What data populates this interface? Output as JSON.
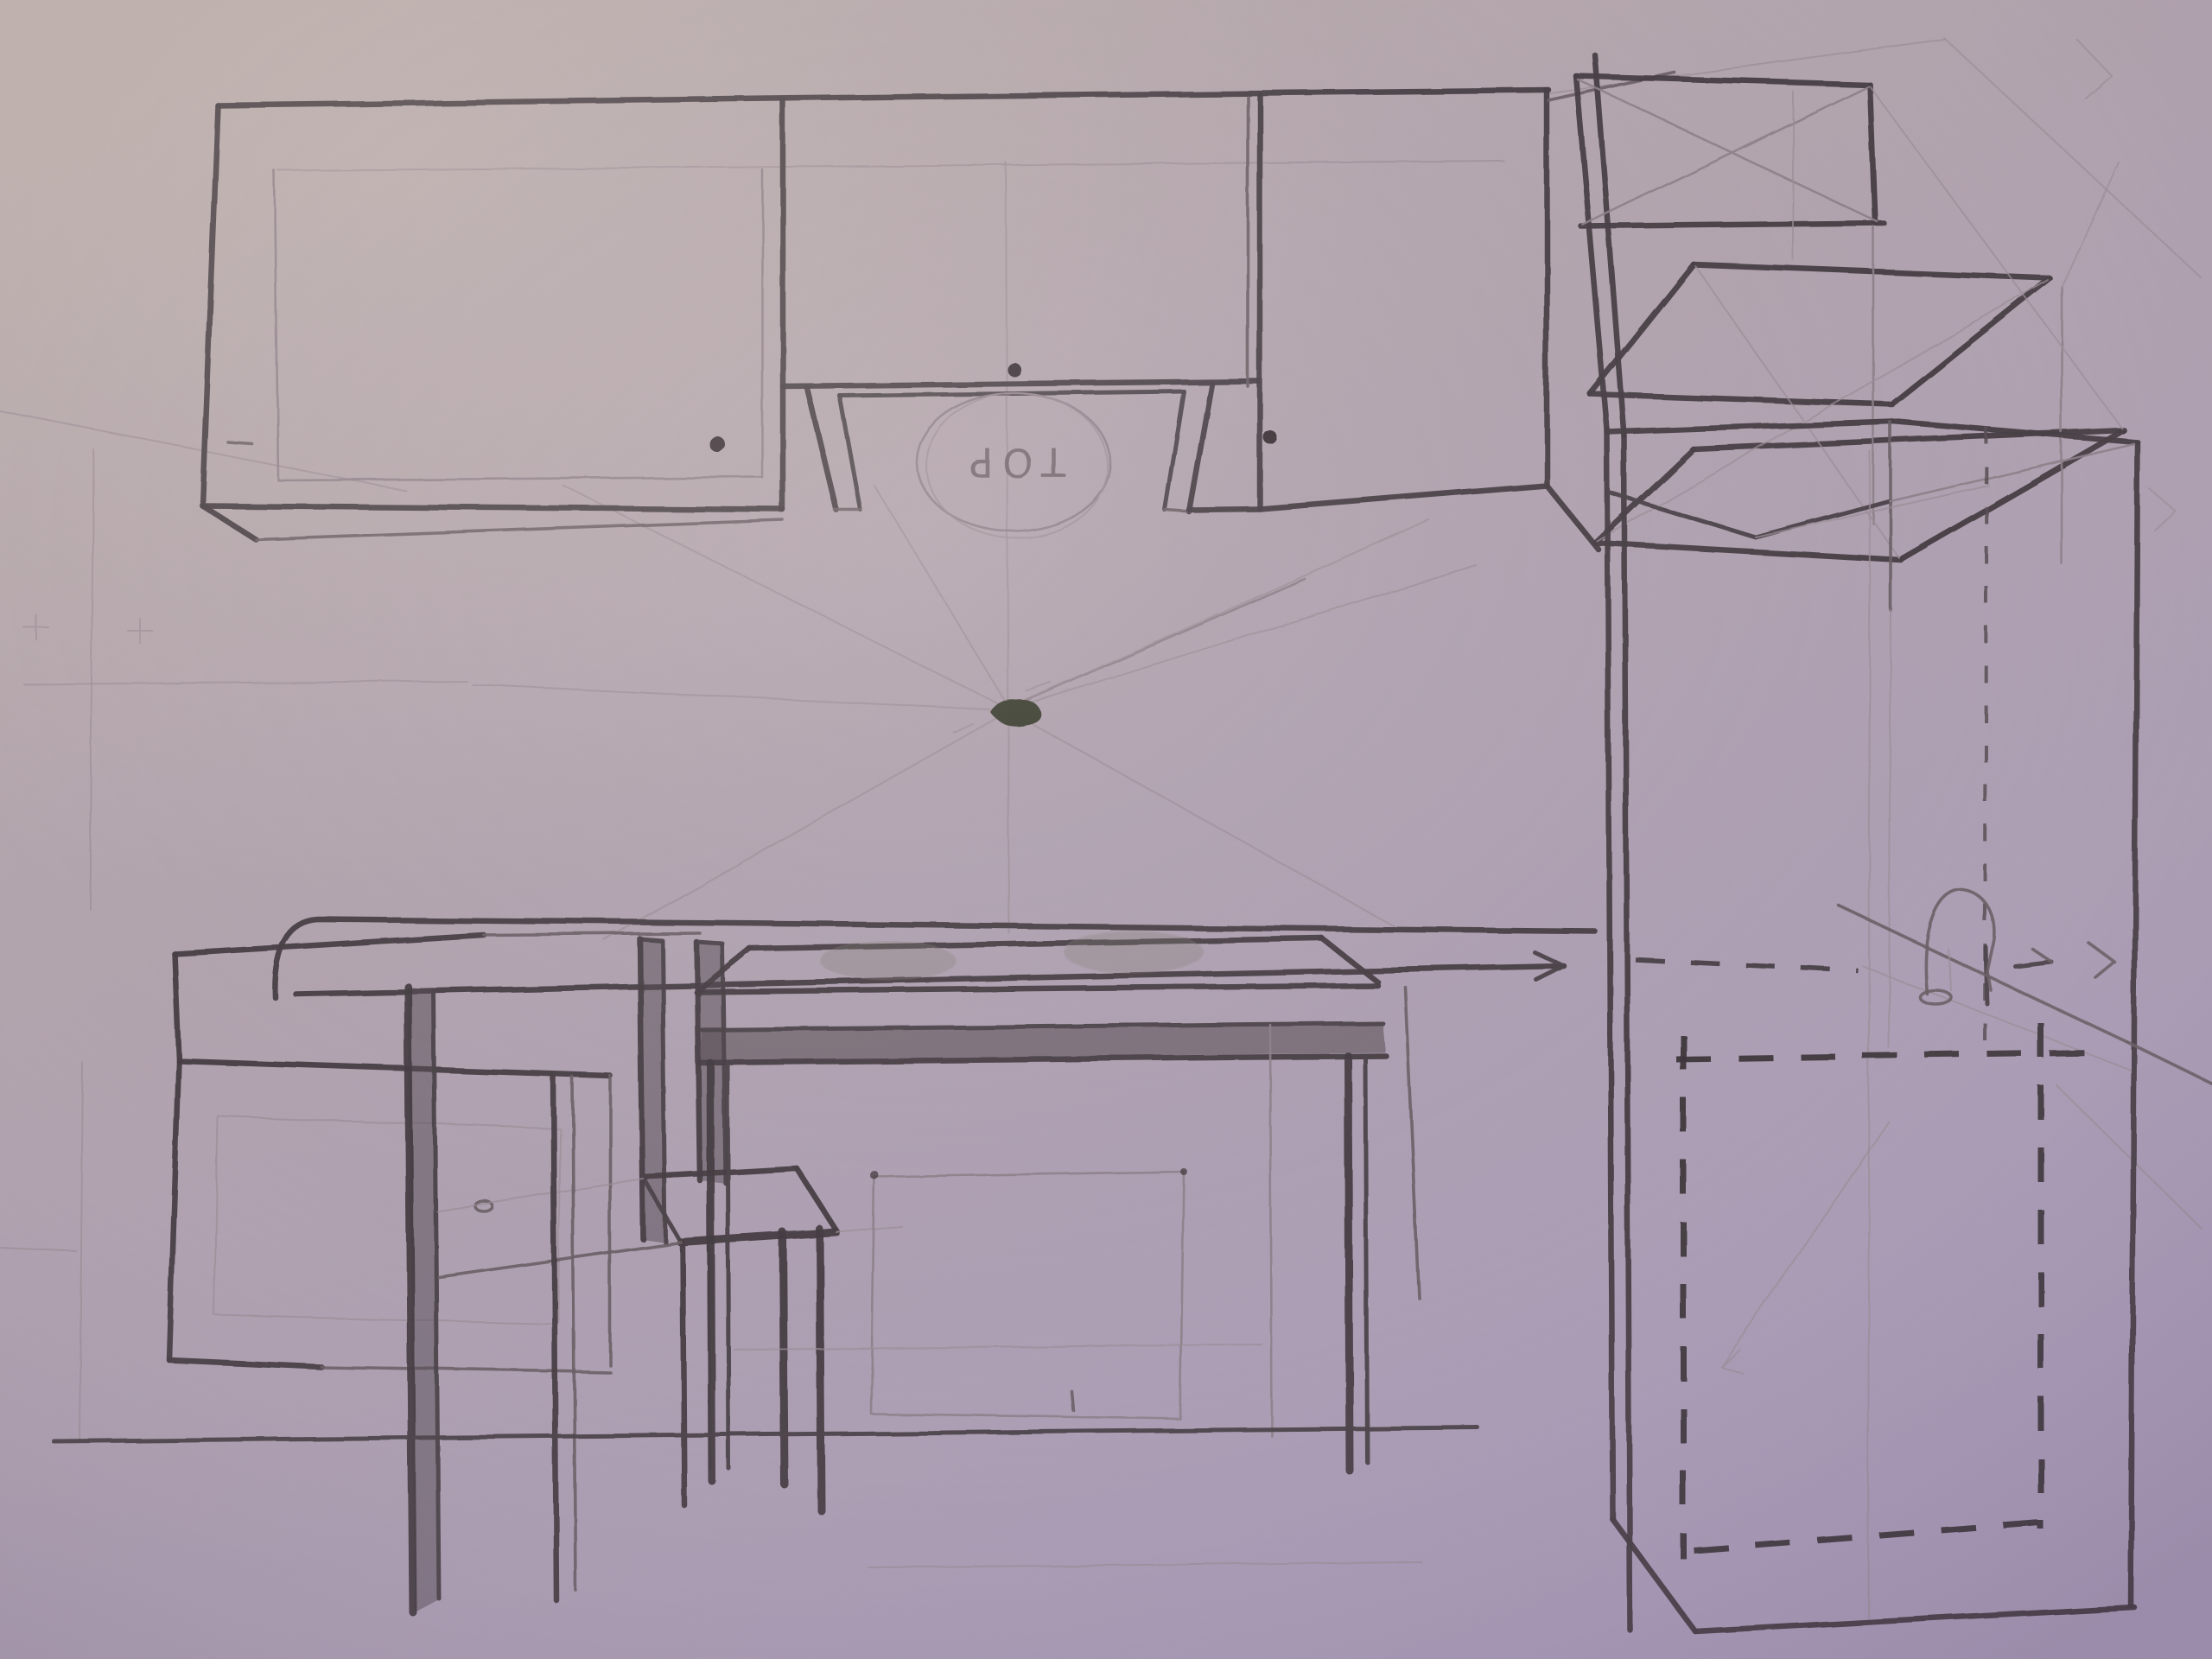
{
  "sketch": {
    "subject": "One-point perspective pencil sketch of a kitchen",
    "medium": "graphite on paper, photographed with a purple cast",
    "hood_label": "TOP",
    "hood_label_note": "written upside-down inside a circle in the niche under the middle wall cabinet",
    "palette": {
      "paper_top_left": "#b9aca8",
      "paper_mid": "#b2a4ae",
      "paper_bottom": "#ab9db8",
      "graphite_dark": "#453d42",
      "graphite_mid": "#6a5e64",
      "graphite_light": "#9b8d95",
      "vp_blot": "#3e4031"
    },
    "elements": [
      {
        "name": "upper-cabinet-row",
        "detail": "three wall cabinets with round door knobs"
      },
      {
        "name": "hood-recess",
        "detail": "open niche below middle cabinet with circled TOP mark"
      },
      {
        "name": "wall-shelf-unit",
        "detail": "open frame with two slanted shelves, top right"
      },
      {
        "name": "tall-cabinet",
        "detail": "full-height unit with dashed hidden-appliance outline"
      },
      {
        "name": "countertop",
        "detail": "long counter band ending in an arrow at the tall cabinet"
      },
      {
        "name": "base-cabinet",
        "detail": "box cabinet, lower left"
      },
      {
        "name": "chair",
        "detail": "side chair with dark shaded back posts and long legs"
      },
      {
        "name": "table-stove",
        "detail": "table with shaded apron, two oval burners, faint oven square"
      },
      {
        "name": "sink-faucet",
        "detail": "gooseneck tap sketched on the right counter"
      },
      {
        "name": "vanishing-point",
        "detail": "dark blot with radiating construction lines"
      },
      {
        "name": "floor-line",
        "detail": "heavy horizontal floor line under the furniture legs"
      }
    ]
  }
}
